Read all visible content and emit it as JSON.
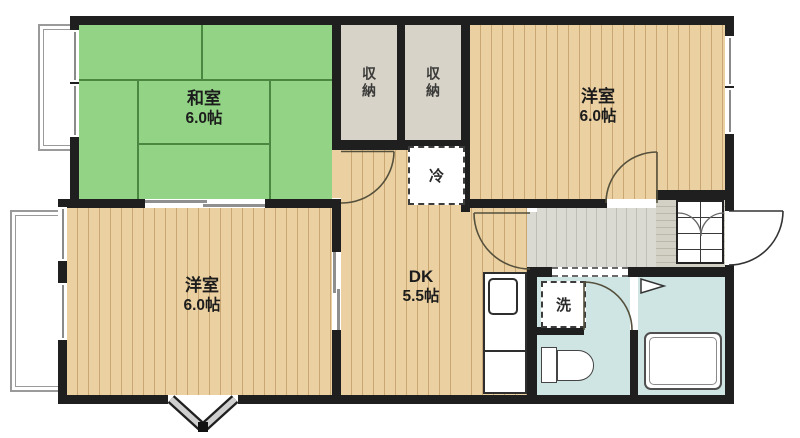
{
  "plan_type": "apartment-floor-plan-2DK",
  "rooms": {
    "washitsu": {
      "name": "和室",
      "size": "6.0帖"
    },
    "yoshitsu_upper": {
      "name": "洋室",
      "size": "6.0帖"
    },
    "yoshitsu_lower": {
      "name": "洋室",
      "size": "6.0帖"
    },
    "dk": {
      "name": "DK",
      "size": "5.5帖"
    },
    "closet_left": {
      "name": "収納"
    },
    "closet_right": {
      "name": "収納"
    }
  },
  "fixtures": {
    "refrigerator": {
      "label": "冷"
    },
    "washer": {
      "label": "洗"
    }
  },
  "colors": {
    "wall": "#1f1f1f",
    "tatami": "#92d385",
    "tatami_line": "#4c8742",
    "wood": "#ebd1a2",
    "wood_line": "#c9a672",
    "closet": "#d7d3c9",
    "hall": "#dadad3",
    "hall_line": "#bfbfb7",
    "genkan": "#d3d0c5",
    "genkan_line": "#bab7ab",
    "wet": "#cfe5e3"
  }
}
